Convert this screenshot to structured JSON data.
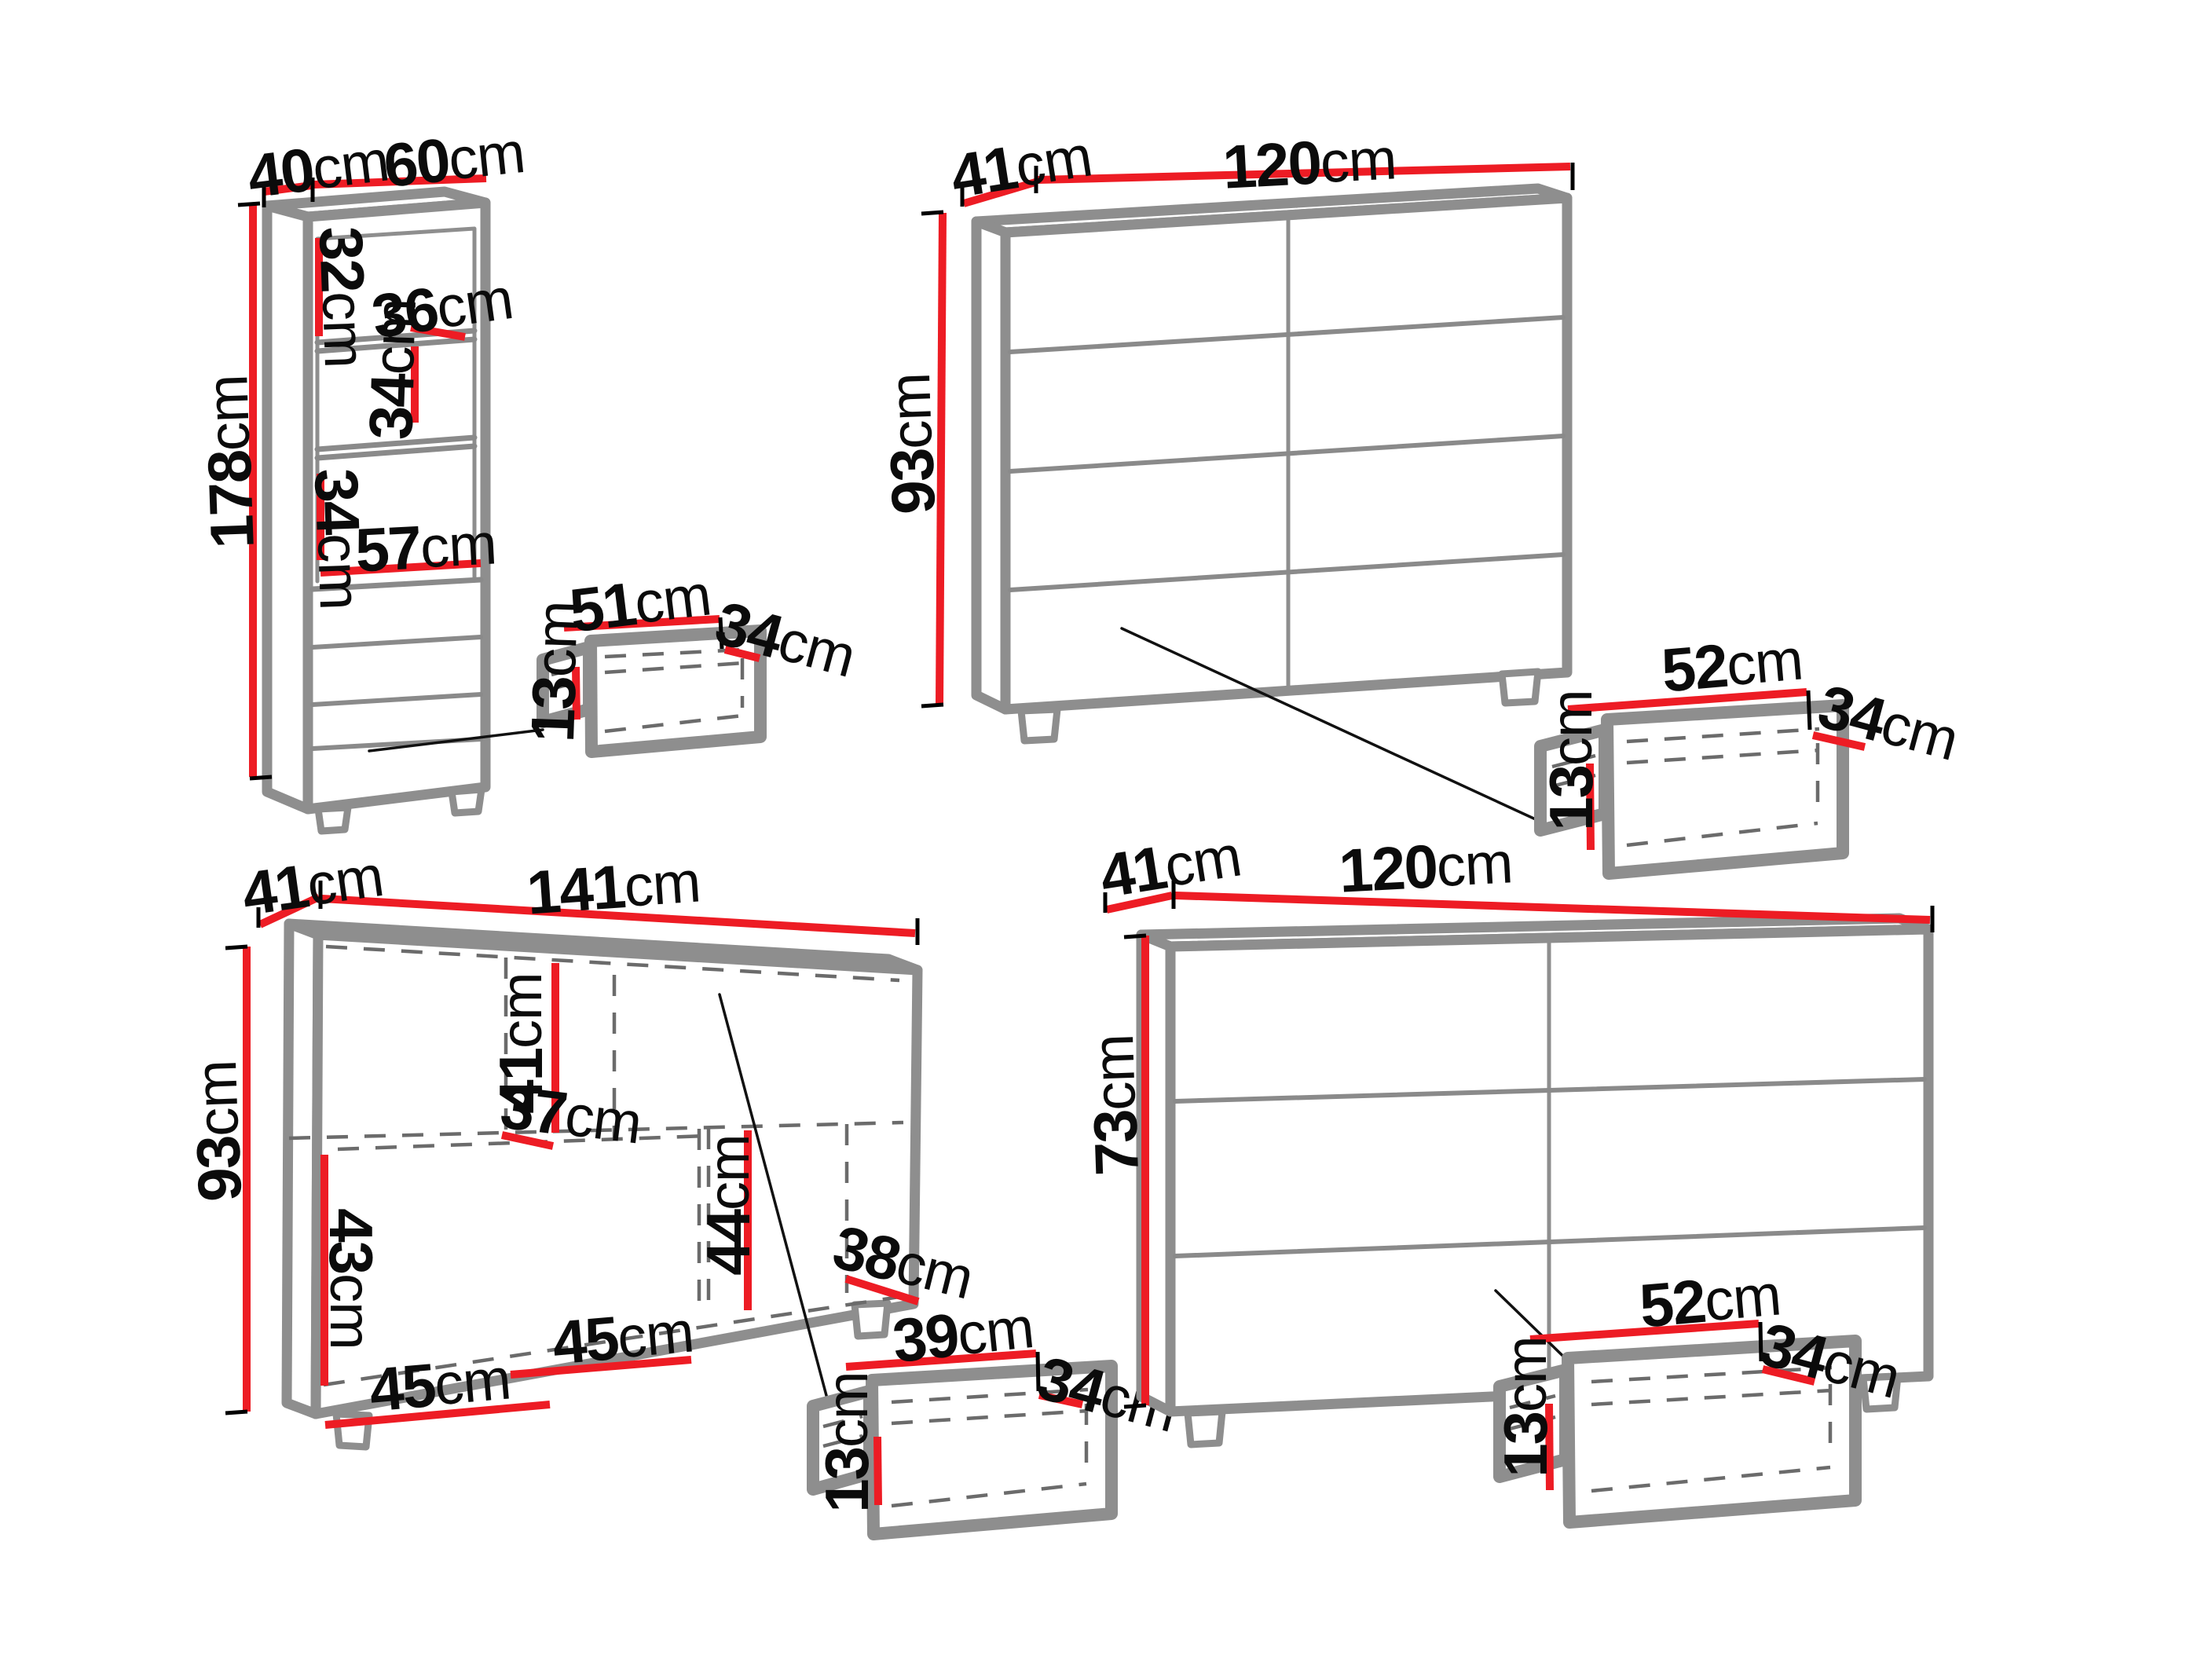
{
  "title": "Furniture set dimensions diagram",
  "palette": {
    "dimension_line": "#ed1c24",
    "furniture_line": "#8e8e8e",
    "text": "#0b0b0b",
    "background": "#ffffff"
  },
  "items": {
    "bookcase": {
      "kind": "tall shelf cabinet",
      "depth": "40cm",
      "width": "60cm",
      "height": "178cm",
      "interior": [
        "32cm",
        "36cm",
        "34cm",
        "34cm",
        "57cm"
      ],
      "drawer": {
        "width": "51cm",
        "depth": "34cm",
        "height": "13cm"
      }
    },
    "chest_top": {
      "kind": "chest of drawers",
      "depth": "41cm",
      "width": "120cm",
      "height": "93cm",
      "drawer": {
        "width": "52cm",
        "depth": "34cm",
        "height": "13cm"
      }
    },
    "sideboard": {
      "kind": "sideboard",
      "depth": "41cm",
      "width": "141cm",
      "height": "93cm",
      "interior": [
        "41cm",
        "37cm",
        "43cm",
        "45cm",
        "45cm",
        "44cm",
        "38cm"
      ],
      "drawer": {
        "width": "39cm",
        "depth": "34cm",
        "height": "13cm"
      }
    },
    "chest_bottom": {
      "kind": "chest of drawers",
      "depth": "41cm",
      "width": "120cm",
      "height": "73cm",
      "drawer": {
        "width": "52cm",
        "depth": "34cm",
        "height": "13cm"
      }
    }
  },
  "labels": {
    "unit": "cm",
    "bk_depth": {
      "num": "40"
    },
    "bk_width": {
      "num": "60"
    },
    "bk_height": {
      "num": "178"
    },
    "bk_c1": {
      "num": "32"
    },
    "bk_shelf": {
      "num": "36"
    },
    "bk_c2": {
      "num": "34"
    },
    "bk_c3": {
      "num": "34"
    },
    "bk_c4": {
      "num": "57"
    },
    "d1_w": {
      "num": "51"
    },
    "d1_d": {
      "num": "34"
    },
    "d1_h": {
      "num": "13"
    },
    "c1_depth": {
      "num": "41"
    },
    "c1_width": {
      "num": "120"
    },
    "c1_height": {
      "num": "93"
    },
    "d2_w": {
      "num": "52"
    },
    "d2_d": {
      "num": "34"
    },
    "d2_h": {
      "num": "13"
    },
    "sb_depth": {
      "num": "41"
    },
    "sb_width": {
      "num": "141"
    },
    "sb_height": {
      "num": "93"
    },
    "sb_i41": {
      "num": "41"
    },
    "sb_i37": {
      "num": "37"
    },
    "sb_i43": {
      "num": "43"
    },
    "sb_i45a": {
      "num": "45"
    },
    "sb_i45b": {
      "num": "45"
    },
    "sb_i44": {
      "num": "44"
    },
    "sb_i38": {
      "num": "38"
    },
    "d3_w": {
      "num": "39"
    },
    "d3_d": {
      "num": "34"
    },
    "d3_h": {
      "num": "13"
    },
    "c2_depth": {
      "num": "41"
    },
    "c2_width": {
      "num": "120"
    },
    "c2_height": {
      "num": "73"
    },
    "d4_w": {
      "num": "52"
    },
    "d4_d": {
      "num": "34"
    },
    "d4_h": {
      "num": "13"
    }
  }
}
